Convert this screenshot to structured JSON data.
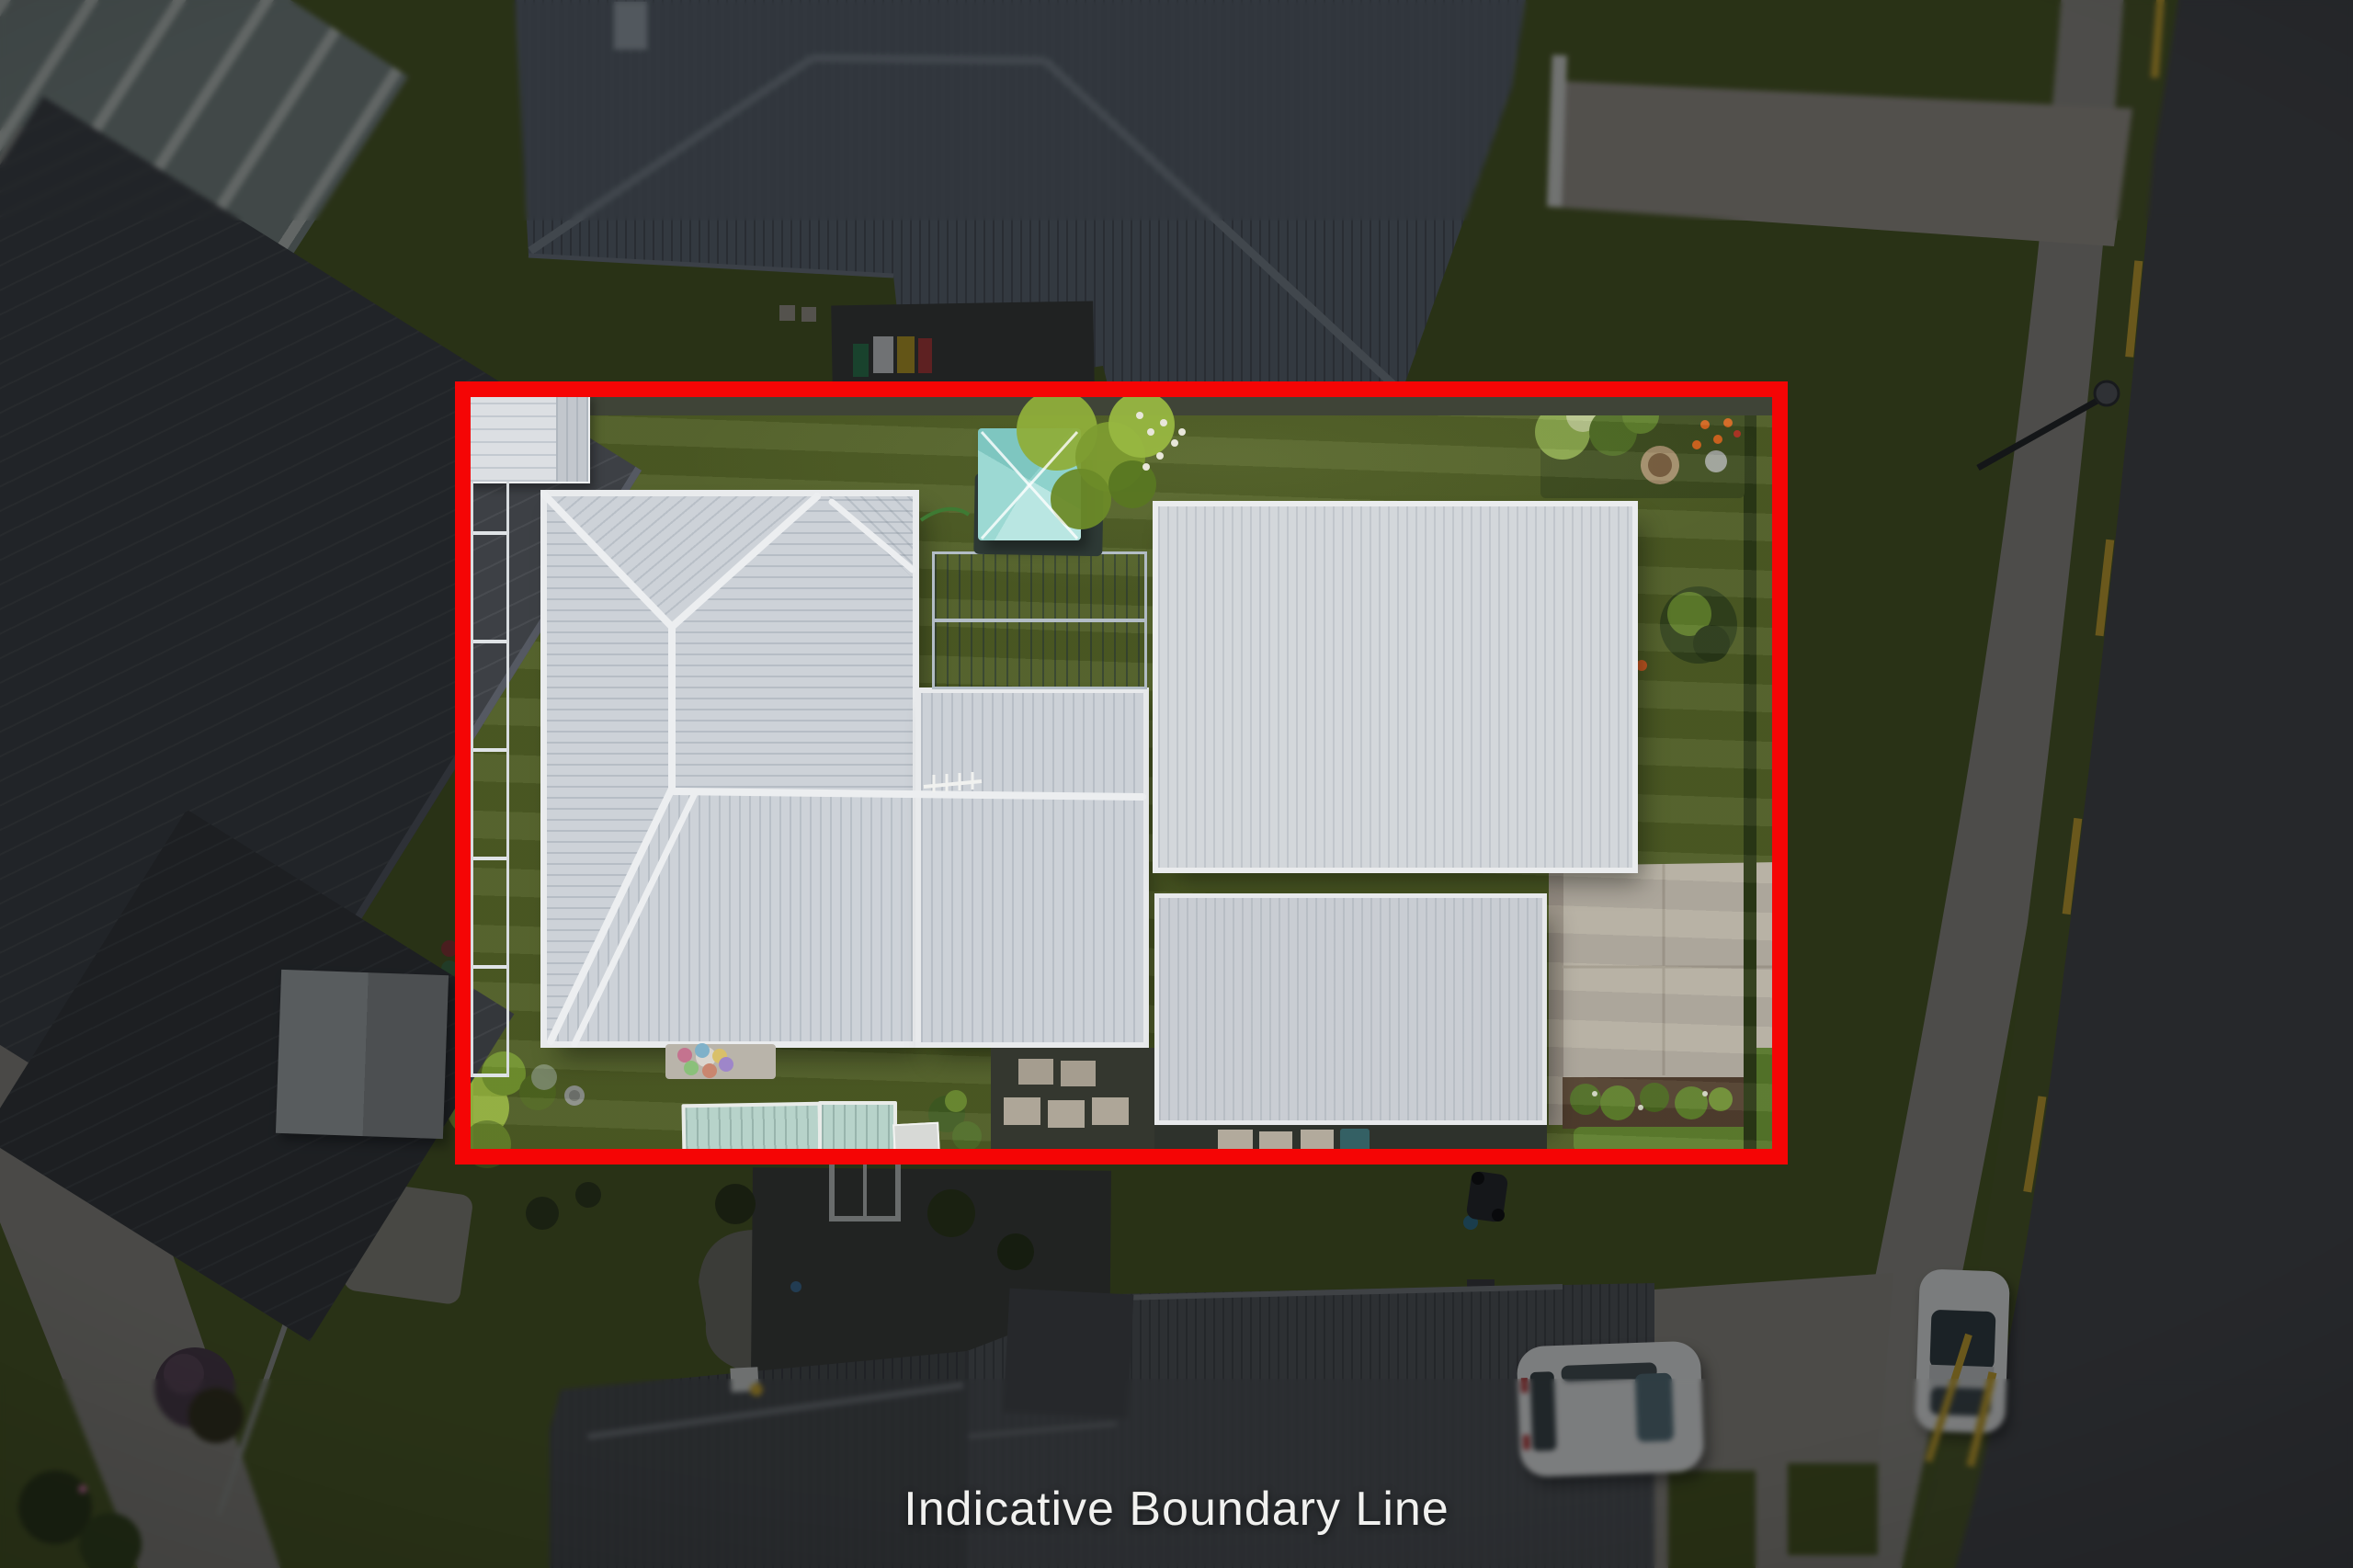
{
  "caption": {
    "text": "Indicative Boundary Line"
  },
  "boundary": {
    "label": "Indicative Boundary Line",
    "color": "#f50505",
    "shape": "rectangle"
  },
  "palette": {
    "caption_text": "#f1f1ef",
    "dim_overlay": "rgba(5,6,8,0.48)",
    "lawn_green": "#4c5a24",
    "main_roof_light_gray": "#cdd2d8",
    "neighbor_roof_gray": "#5f6873",
    "road_asphalt": "#46474b",
    "footpath_concrete": "#8f8c85",
    "driveway_concrete": "#b5aea3",
    "gazebo_teal": "#9cd9d3",
    "louvre_slate_blue": "#8292a6",
    "road_marking_yellow": "#c7a42e"
  }
}
